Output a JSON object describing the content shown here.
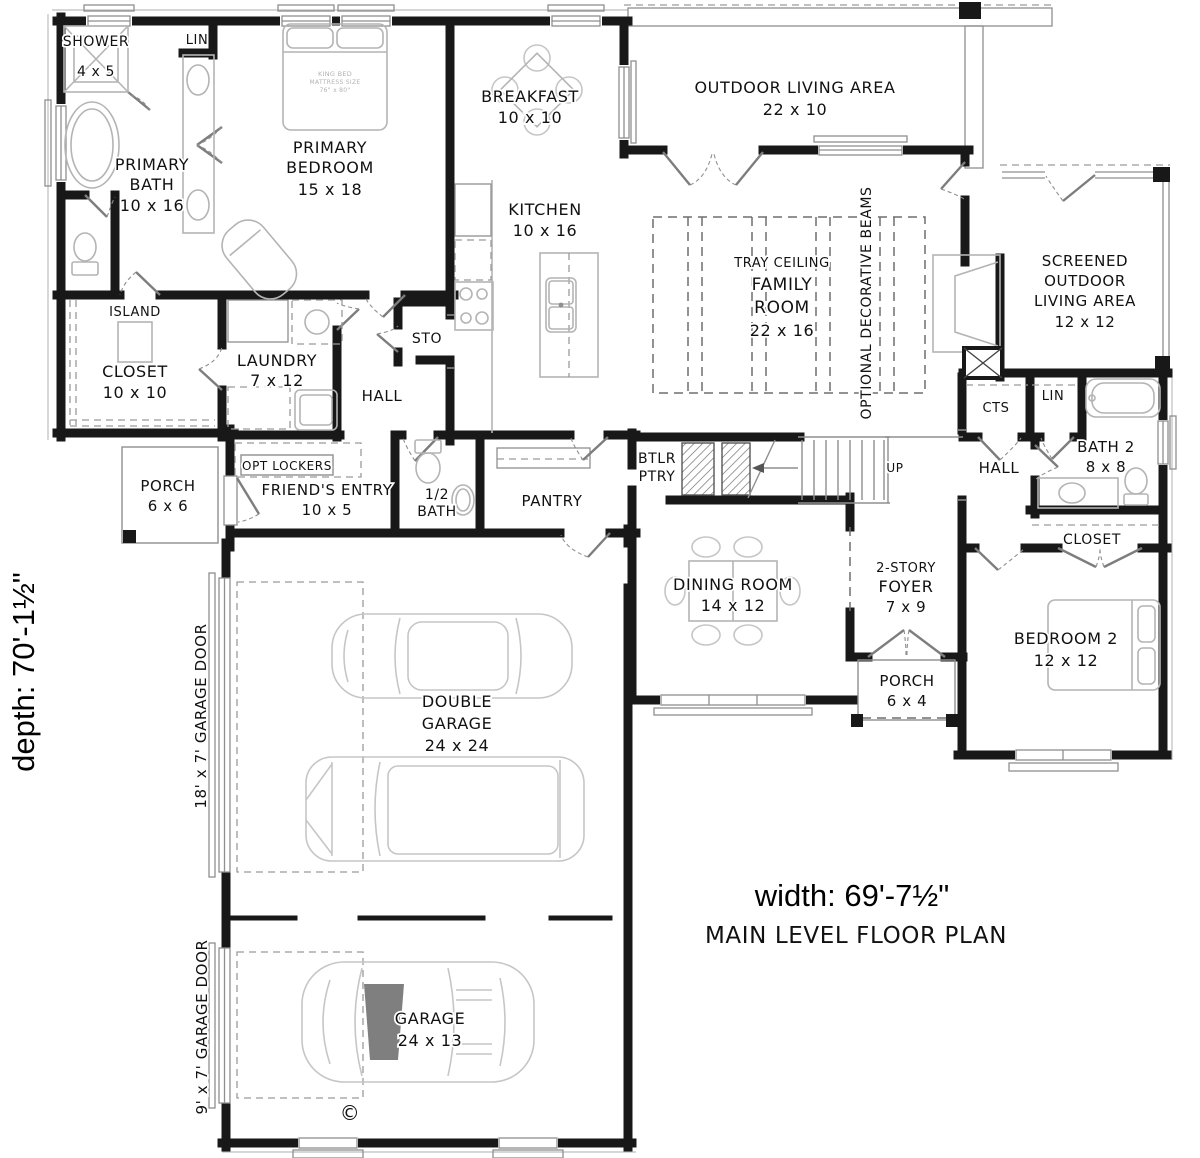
{
  "plan": {
    "name": "MAIN LEVEL FLOOR PLAN",
    "width_label": "width: 69'-7½\"",
    "depth_label": "depth: 70'-1½\"",
    "copyright": "©"
  },
  "rooms": {
    "shower": {
      "name": "SHOWER",
      "dims": "4 x 5"
    },
    "linen_bath": {
      "name": "LIN"
    },
    "primary_bath": {
      "name": "PRIMARY",
      "name2": "BATH",
      "dims": "10 x 16"
    },
    "primary_bedroom": {
      "name": "PRIMARY",
      "name2": "BEDROOM",
      "dims": "15 x 18"
    },
    "breakfast": {
      "name": "BREAKFAST",
      "dims": "10 x 10"
    },
    "kitchen": {
      "name": "KITCHEN",
      "dims": "10 x 16"
    },
    "outdoor_living": {
      "name": "OUTDOOR LIVING AREA",
      "dims": "22 x 10"
    },
    "family_room": {
      "note": "TRAY CEILING",
      "name": "FAMILY",
      "name2": "ROOM",
      "dims": "22 x 16",
      "beams": "OPTIONAL DECORATIVE BEAMS"
    },
    "screened_outdoor": {
      "name": "SCREENED",
      "name2": "OUTDOOR",
      "name3": "LIVING AREA",
      "dims": "12 x 12"
    },
    "island": {
      "name": "ISLAND"
    },
    "closet_primary": {
      "name": "CLOSET",
      "dims": "10 x 10"
    },
    "laundry": {
      "name": "LAUNDRY",
      "dims": "7 x 12"
    },
    "storage": {
      "name": "STO"
    },
    "hall_left": {
      "name": "HALL"
    },
    "opt_lockers": {
      "name": "OPT LOCKERS"
    },
    "porch_left": {
      "name": "PORCH",
      "dims": "6 x 6"
    },
    "friends_entry": {
      "name": "FRIEND'S ENTRY",
      "dims": "10 x 5"
    },
    "half_bath": {
      "name": "1/2",
      "name2": "BATH"
    },
    "pantry": {
      "name": "PANTRY"
    },
    "butlers_pantry": {
      "name": "BTLR",
      "name2": "PTRY"
    },
    "stairs": {
      "direction": "UP"
    },
    "dining_room": {
      "name": "DINING ROOM",
      "dims": "14 x 12"
    },
    "cts": {
      "name": "CTS"
    },
    "linen_hall": {
      "name": "LIN"
    },
    "bath2": {
      "name": "BATH 2",
      "dims": "8 x 8"
    },
    "hall_right": {
      "name": "HALL"
    },
    "closet_bedroom2": {
      "name": "CLOSET"
    },
    "foyer": {
      "name": "2-STORY",
      "name2": "FOYER",
      "dims": "7 x 9"
    },
    "porch_right": {
      "name": "PORCH",
      "dims": "6 x 4"
    },
    "bedroom2": {
      "name": "BEDROOM 2",
      "dims": "12 x 12"
    },
    "double_garage": {
      "name": "DOUBLE",
      "name2": "GARAGE",
      "dims": "24 x 24"
    },
    "garage": {
      "name": "GARAGE",
      "dims": "24 x 13"
    }
  },
  "annotations": {
    "garage_door_large": "18' x 7' GARAGE DOOR",
    "garage_door_small": "9' x 7' GARAGE DOOR",
    "king_bed_line1": "KING BED",
    "king_bed_line2": "MATTRESS SIZE",
    "king_bed_line3": "76\" x 80\""
  }
}
